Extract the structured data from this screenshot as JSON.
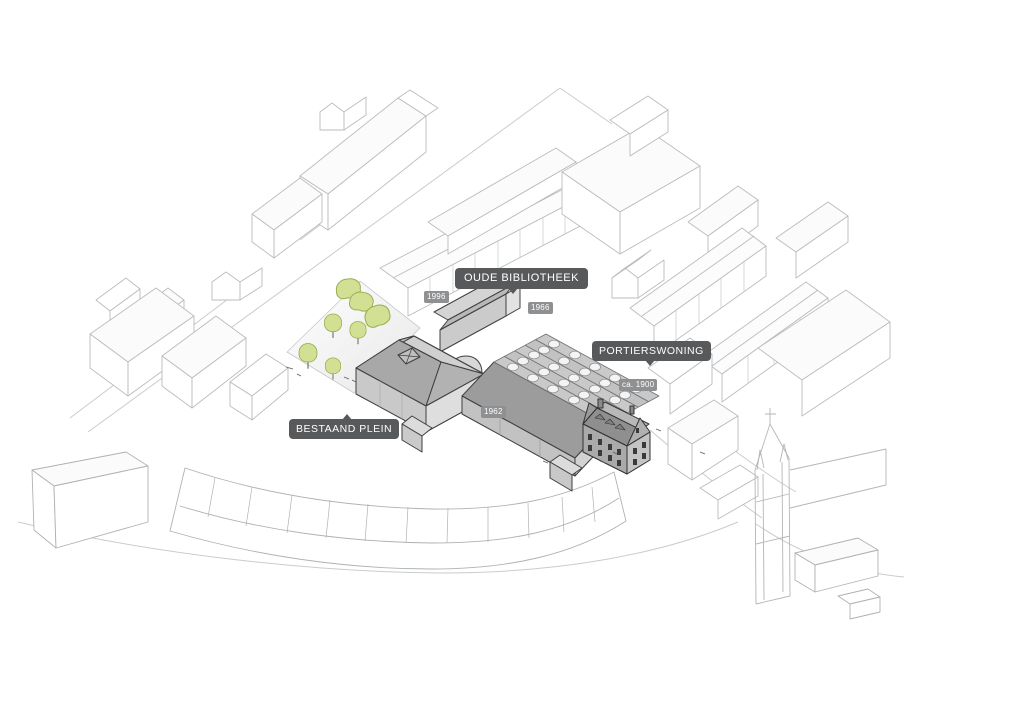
{
  "diagram": {
    "type": "axonometric-site-plan",
    "labels": {
      "oude_bibliotheek": "OUDE BIBLIOTHEEK",
      "portierswoning": "PORTIERSWONING",
      "bestaand_plein": "BESTAAND PLEIN"
    },
    "year_tags": {
      "plein_wing": "1996",
      "middle_wing": "1966",
      "hall_roof": "1962",
      "portierswoning": "ca. 1900"
    },
    "colors": {
      "background": "#ffffff",
      "label_bg": "#58595b",
      "label_text": "#ffffff",
      "year_tag_bg": "#8e9092",
      "highlight_wall": "#c9c9c9",
      "highlight_roof": "#9c9c9c",
      "context_outline": "#b9bcbe",
      "tree_fill": "#d2e094",
      "tree_stroke": "#99ad52"
    }
  }
}
